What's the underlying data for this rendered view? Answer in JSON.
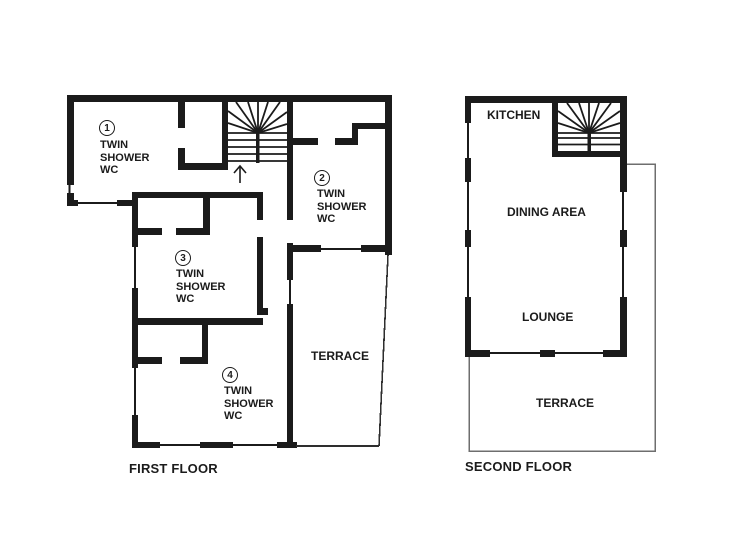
{
  "colors": {
    "wall": "#1b1b1b",
    "terr1": "#2e2e2e",
    "terr2": "#6e6e6e"
  },
  "first_floor": {
    "title": "FIRST FLOOR",
    "terrace_label": "TERRACE",
    "rooms": [
      {
        "number": "1",
        "label": "TWIN\nSHOWER\nWC"
      },
      {
        "number": "2",
        "label": "TWIN\nSHOWER\nWC"
      },
      {
        "number": "3",
        "label": "TWIN\nSHOWER\nWC"
      },
      {
        "number": "4",
        "label": "TWIN\nSHOWER\nWC"
      }
    ]
  },
  "second_floor": {
    "title": "SECOND FLOOR",
    "kitchen_label": "KITCHEN",
    "dining_label": "DINING AREA",
    "lounge_label": "LOUNGE",
    "terrace_label": "TERRACE"
  }
}
